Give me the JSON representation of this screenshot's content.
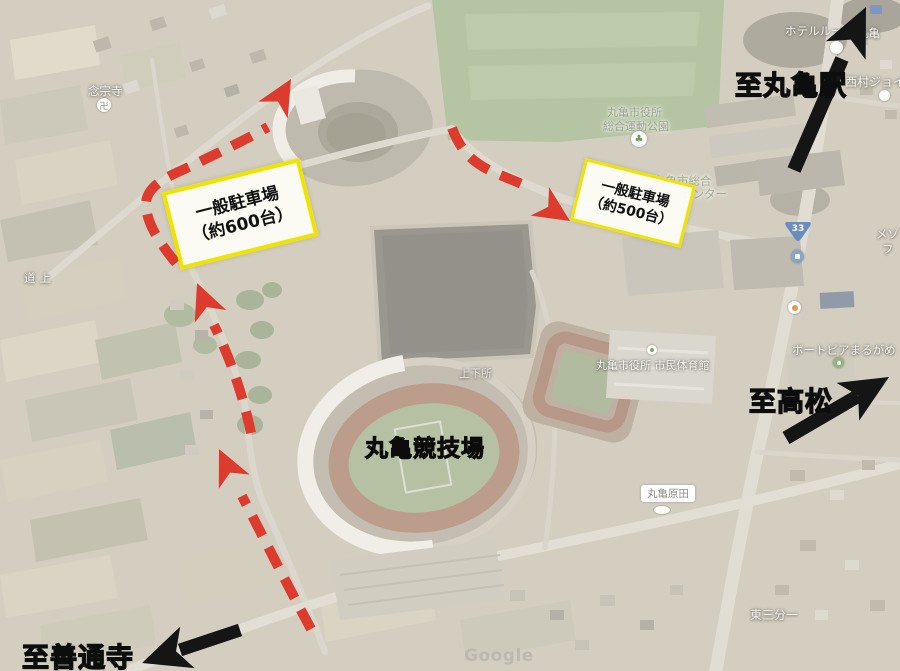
{
  "annotations": {
    "parking_600": {
      "line1": "一般駐車場",
      "line2": "（約600台）"
    },
    "parking_500": {
      "line1": "一般駐車場",
      "line2": "（約500台）"
    },
    "to_marugame_station": "至丸亀駅",
    "to_takamatsu": "至高松",
    "to_zentsuji": "至善通寺",
    "stadium_title": "丸亀競技場"
  },
  "map_labels": {
    "temple": "念宗寺",
    "michiue": "道上",
    "jogesho": "上下所",
    "park_name_line1": "丸亀市役所",
    "park_name_line2": "総合運動公園",
    "sports_center_line1": "丸亀市総合",
    "sports_center_line2": "センター",
    "hotel_left": "ホテルルー",
    "hotel_right": "丸亀",
    "nishimura_joy": "西村ジョイ",
    "boatpia": "ボートピアまるがめ",
    "citizen_gym": "丸亀市役所 市民体育館",
    "marugame_harada": "丸亀原田",
    "higashi_sanbuichi": "東三分一",
    "route_number": "33",
    "partial_text_line1": "メゾ",
    "partial_text_line2": "フ",
    "watermark": "Google"
  },
  "colors": {
    "route_red": "#dd3b2d",
    "parking_box_border": "#efe400",
    "parking_box_bg": "#fdfdf6",
    "arrow_black": "#151515",
    "route_shield_blue": "#6b8cbf"
  }
}
